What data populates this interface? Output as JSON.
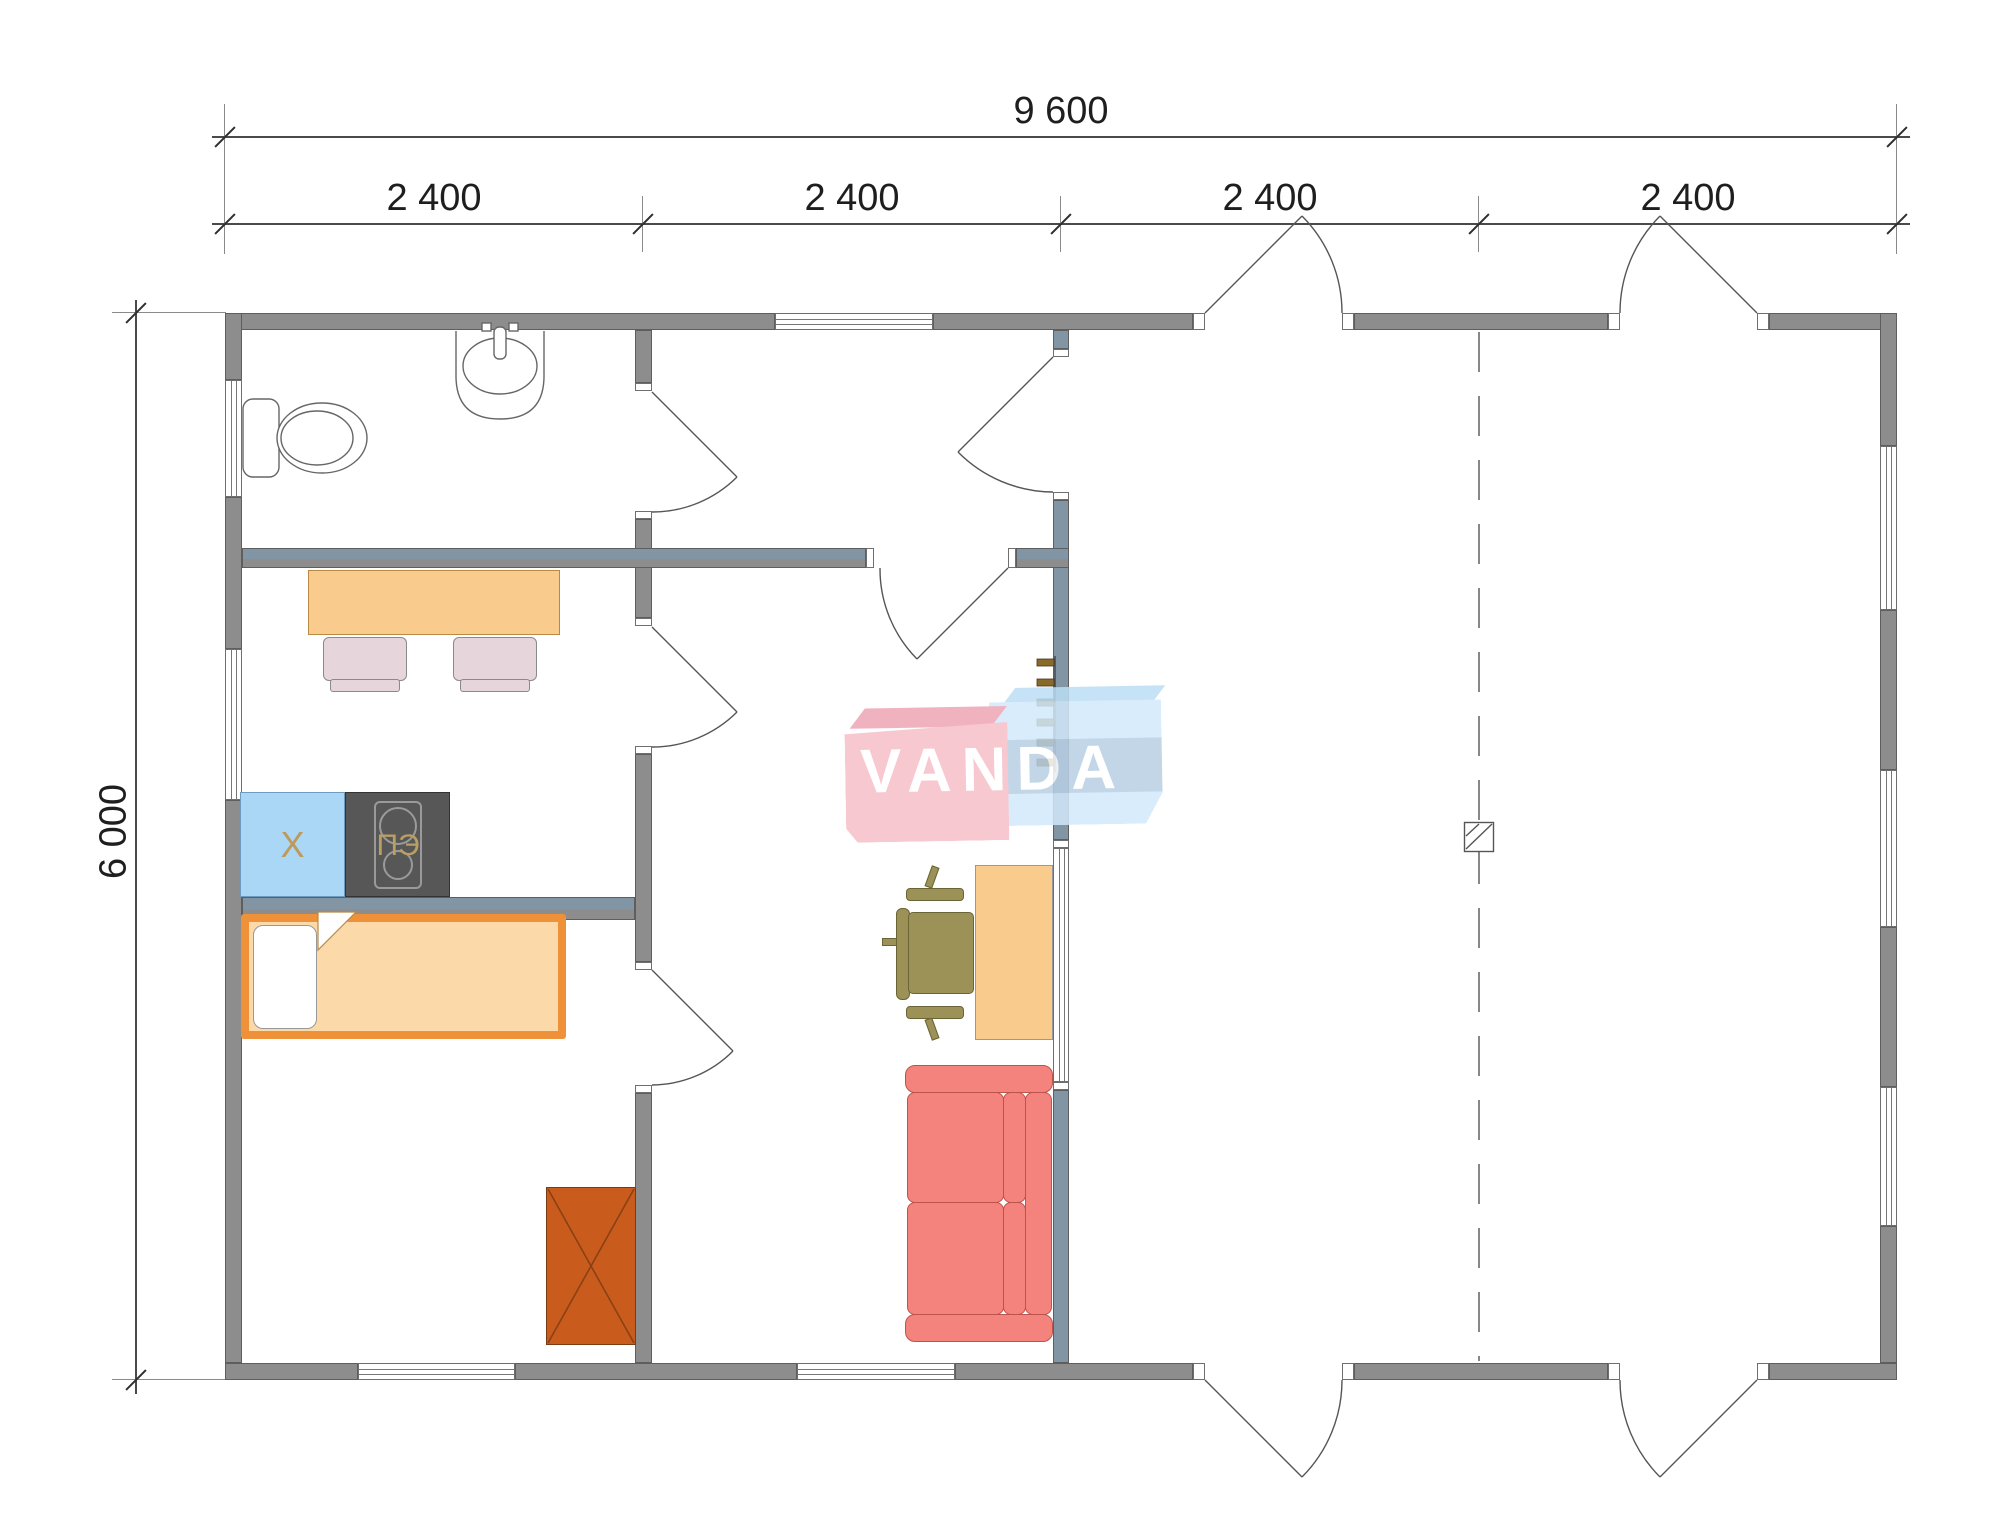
{
  "dimensions": {
    "total_width": "9 600",
    "segments": [
      "2 400",
      "2 400",
      "2 400",
      "2 400"
    ],
    "total_height": "6 000"
  },
  "labels": {
    "fridge": "X",
    "stove": "ПЭ"
  },
  "watermark": {
    "text": "VANDA"
  },
  "colors": {
    "wall": "#8d8d8d",
    "wall-blue": "#8295a4",
    "line": "#555555",
    "furn-light": "#f9cb8d",
    "mattress": "#fcd9a8",
    "bed-frame": "#ef9138",
    "fridge": "#a9d7f5",
    "fridge-label": "#bd9a5c",
    "stove": "#575757",
    "stove-label": "#b99f63",
    "chair-pink": "#e6d5da",
    "chair-olive": "#9c9156",
    "sofa": "#f4837d",
    "sofa-line": "#bb544c",
    "wardrobe": "#c95c1d",
    "logo-pink": "#f6bfc8",
    "logo-pink-top": "#eea5b5",
    "logo-blue": "#d2e9fb",
    "logo-blue-top": "#bcdef5",
    "logo-text": "#ffffff"
  }
}
